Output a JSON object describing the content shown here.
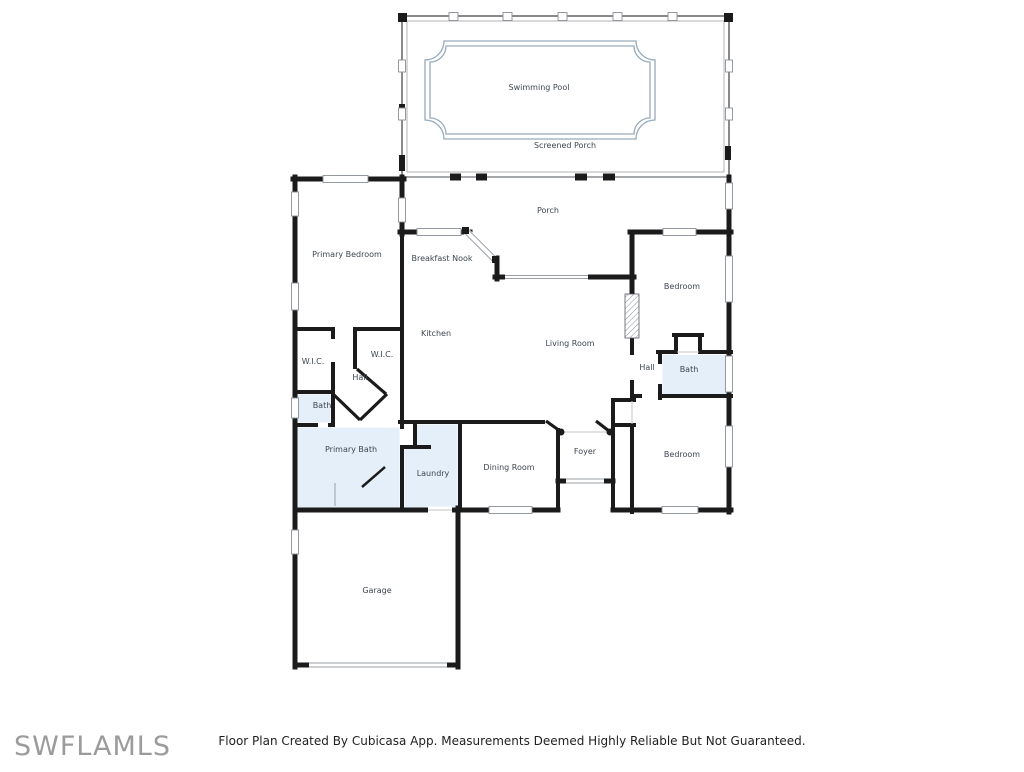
{
  "watermark": "SWFLAMLS",
  "footer": {
    "disclaimer": "Floor Plan Created By Cubicasa App. Measurements Deemed Highly Reliable But Not Guaranteed."
  },
  "floor_plan": {
    "rooms": {
      "swimming_pool": {
        "label": "Swimming Pool"
      },
      "screened_porch": {
        "label": "Screened Porch"
      },
      "porch": {
        "label": "Porch"
      },
      "primary_bedroom": {
        "label": "Primary Bedroom"
      },
      "breakfast_nook": {
        "label": "Breakfast Nook"
      },
      "kitchen": {
        "label": "Kitchen"
      },
      "living_room": {
        "label": "Living Room"
      },
      "bedroom_upper": {
        "label": "Bedroom"
      },
      "hall_right": {
        "label": "Hall"
      },
      "bath_right": {
        "label": "Bath"
      },
      "wic_left": {
        "label": "W.I.C."
      },
      "wic_right": {
        "label": "W.I.C."
      },
      "hall_left": {
        "label": "Hall"
      },
      "bath_left": {
        "label": "Bath"
      },
      "primary_bath": {
        "label": "Primary Bath"
      },
      "laundry": {
        "label": "Laundry"
      },
      "dining_room": {
        "label": "Dining Room"
      },
      "foyer": {
        "label": "Foyer"
      },
      "bedroom_lower": {
        "label": "Bedroom"
      },
      "garage": {
        "label": "Garage"
      }
    },
    "colors": {
      "wall": "#1b1b1b",
      "wet_room_fill": "#e4eff9",
      "pool_fill": "#e1eefa",
      "pool_border": "#96abbc",
      "label_text": "#3e4650",
      "watermark_text": "#9b9b9b"
    }
  }
}
